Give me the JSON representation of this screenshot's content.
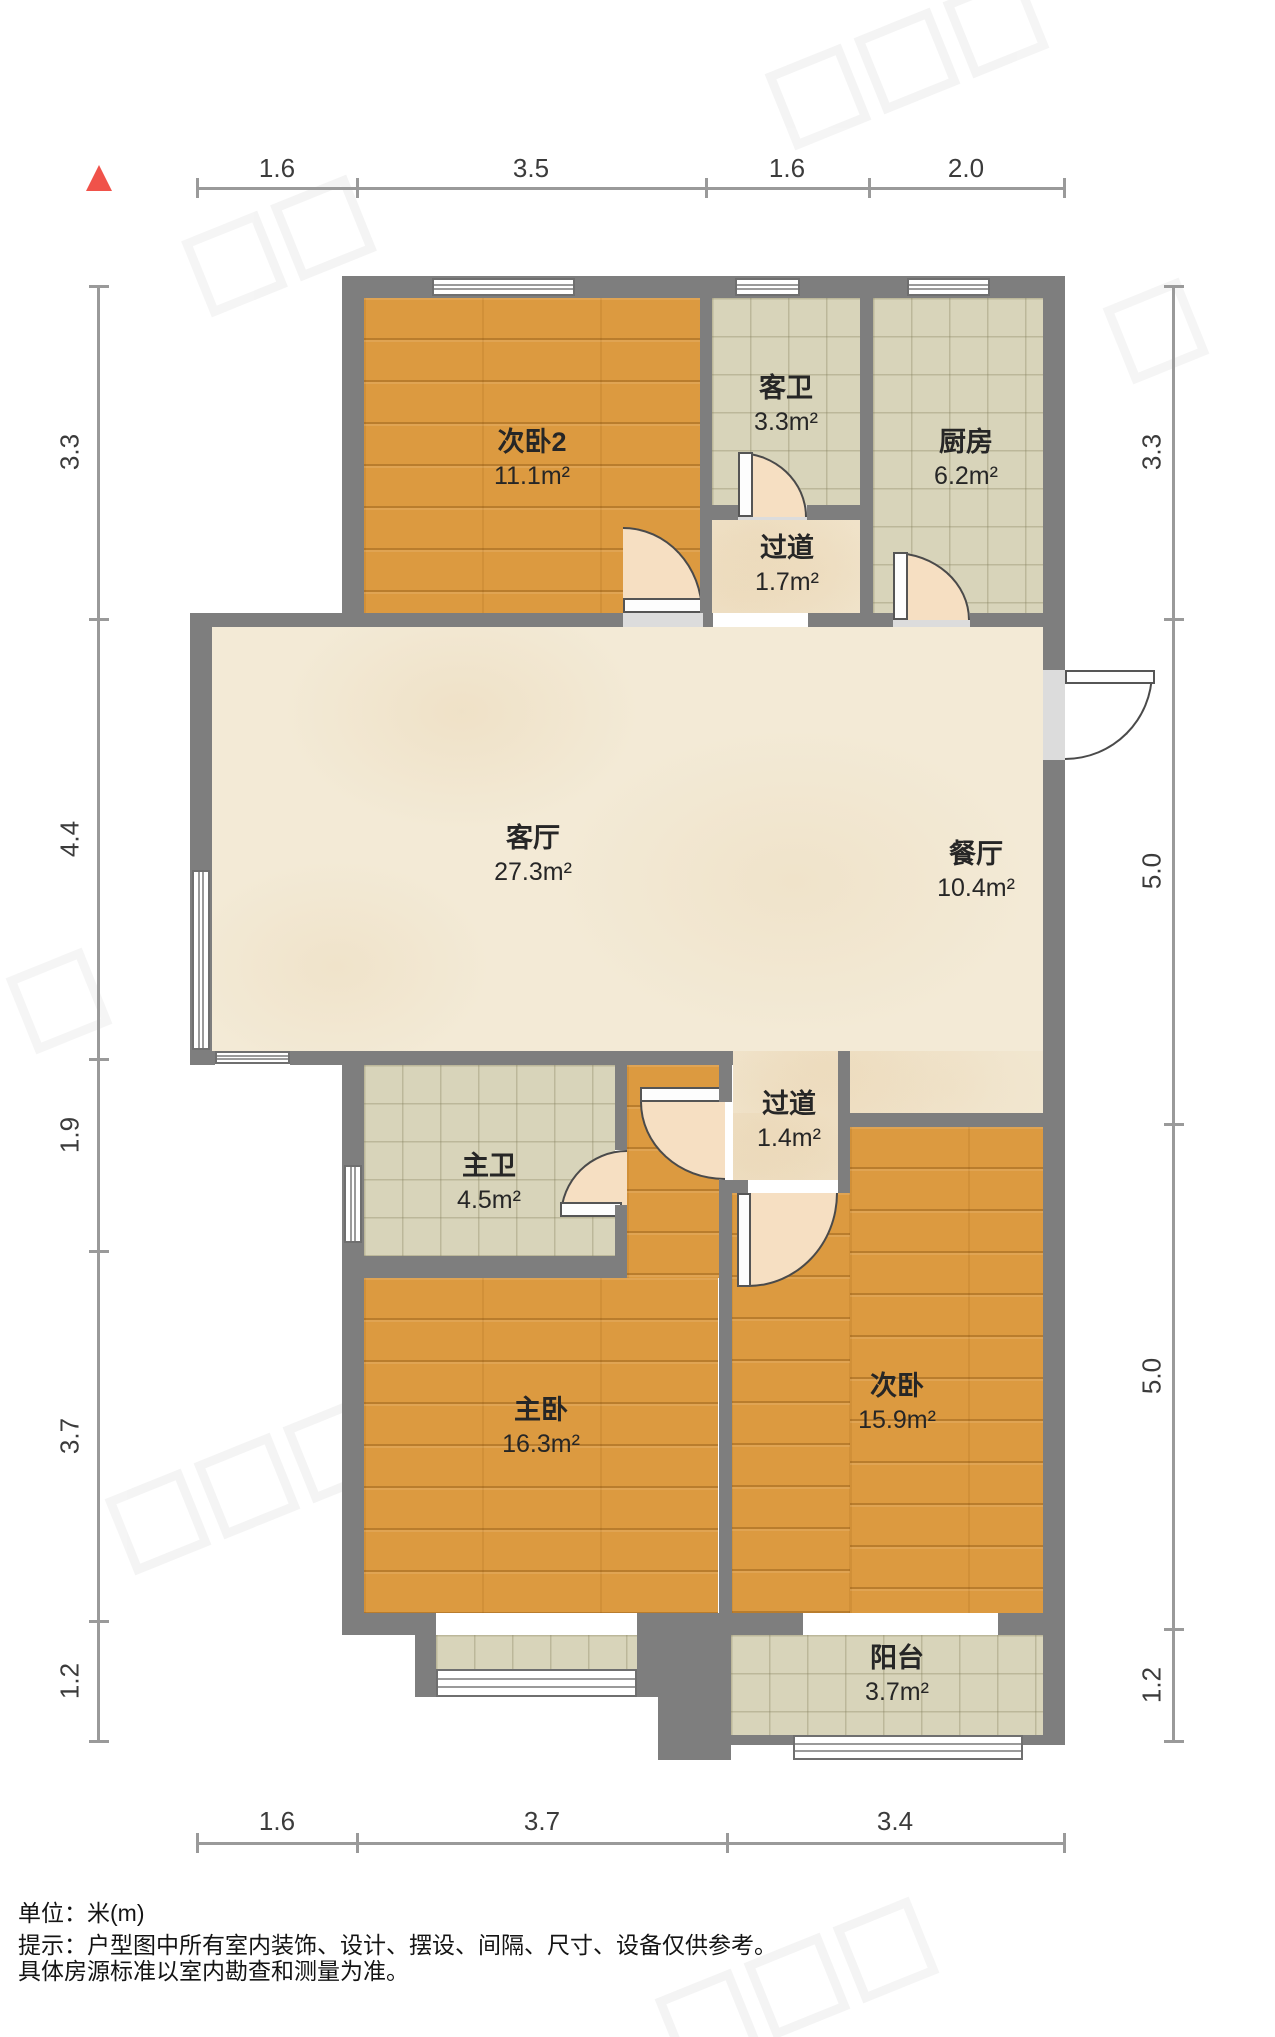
{
  "meta": {
    "type": "apartment-floor-plan",
    "unit": "米(m)"
  },
  "colors": {
    "wall": "#7e7e7e",
    "wood": "#dc9a40",
    "tile": "#d8d4ba",
    "marble": "#f3ead6",
    "swing": "#f6dfc2",
    "dim_line": "#9a9a9a",
    "dim_text": "#3b3b3b",
    "north": "#f0524a"
  },
  "dimensions": {
    "top": [
      "1.6",
      "3.5",
      "1.6",
      "2.0"
    ],
    "left": [
      "3.3",
      "4.4",
      "1.9",
      "3.7",
      "1.2"
    ],
    "right": [
      "3.3",
      "5.0",
      "5.0",
      "1.2"
    ],
    "bottom": [
      "1.6",
      "3.7",
      "3.4"
    ]
  },
  "rooms": [
    {
      "name": "次卧2",
      "area": "11.1m²"
    },
    {
      "name": "客卫",
      "area": "3.3m²"
    },
    {
      "name": "厨房",
      "area": "6.2m²"
    },
    {
      "name": "过道",
      "area": "1.7m²"
    },
    {
      "name": "客厅",
      "area": "27.3m²"
    },
    {
      "name": "餐厅",
      "area": "10.4m²"
    },
    {
      "name": "主卫",
      "area": "4.5m²"
    },
    {
      "name": "过道",
      "area": "1.4m²"
    },
    {
      "name": "主卧",
      "area": "16.3m²"
    },
    {
      "name": "次卧",
      "area": "15.9m²"
    },
    {
      "name": "阳台",
      "area": "3.7m²"
    }
  ],
  "footer": {
    "line1": "单位：米(m)",
    "line2": "提示：户型图中所有室内装饰、设计、摆设、间隔、尺寸、设备仅供参考。",
    "line3": "具体房源标准以室内勘查和测量为准。"
  }
}
